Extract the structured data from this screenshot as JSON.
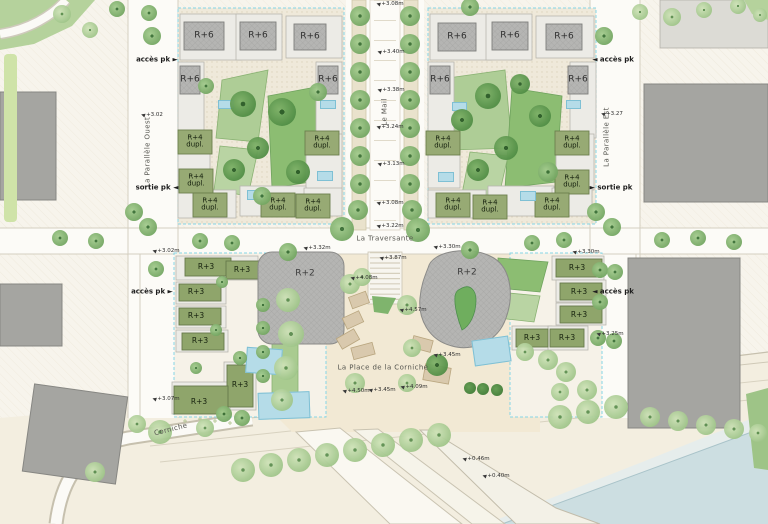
{
  "plan_type": "urban masterplan site plan",
  "streets": [
    {
      "id": "parallele-ouest",
      "label": "La Parallèle Ouest",
      "x": 148,
      "y": 152,
      "rotate": -90
    },
    {
      "id": "le-mail",
      "label": "Le Mail",
      "x": 385,
      "y": 112,
      "rotate": -90
    },
    {
      "id": "parallele-est",
      "label": "La Parallèle Est",
      "x": 607,
      "y": 137,
      "rotate": -90
    },
    {
      "id": "la-traversante",
      "label": "La Traversante",
      "x": 385,
      "y": 239,
      "rotate": 0
    },
    {
      "id": "place-corniche",
      "label": "La Place de la Corniche",
      "x": 383,
      "y": 368,
      "rotate": 0
    },
    {
      "id": "corniche",
      "label": "Corniche",
      "x": 171,
      "y": 430,
      "rotate": -14
    }
  ],
  "access_points": [
    {
      "label": "accès pk ►",
      "x": 157,
      "y": 60
    },
    {
      "label": "sortie pk ◄",
      "x": 157,
      "y": 188
    },
    {
      "label": "accès pk ►",
      "x": 152,
      "y": 292
    },
    {
      "label": "◄ accès pk",
      "x": 613,
      "y": 60
    },
    {
      "label": "► sortie pk",
      "x": 611,
      "y": 188
    },
    {
      "label": "◄ accès pk",
      "x": 613,
      "y": 292
    }
  ],
  "elevations": [
    {
      "v": "+3.08m",
      "x": 390,
      "y": 4
    },
    {
      "v": "+3.40m",
      "x": 391,
      "y": 52
    },
    {
      "v": "+3.38m",
      "x": 391,
      "y": 90
    },
    {
      "v": "+3.24m",
      "x": 390,
      "y": 127
    },
    {
      "v": "+3.13m",
      "x": 391,
      "y": 164
    },
    {
      "v": "+3.08m",
      "x": 390,
      "y": 203
    },
    {
      "v": "+3.22m",
      "x": 390,
      "y": 226
    },
    {
      "v": "+3.02",
      "x": 152,
      "y": 115
    },
    {
      "v": "+3.27",
      "x": 612,
      "y": 114
    },
    {
      "v": "+3.02m",
      "x": 166,
      "y": 251
    },
    {
      "v": "+3.07m",
      "x": 166,
      "y": 399
    },
    {
      "v": "+3.30m",
      "x": 586,
      "y": 252
    },
    {
      "v": "+3.25m",
      "x": 610,
      "y": 334
    },
    {
      "v": "+3.32m",
      "x": 317,
      "y": 248
    },
    {
      "v": "+3.30m",
      "x": 447,
      "y": 247
    },
    {
      "v": "+3.87m",
      "x": 393,
      "y": 258
    },
    {
      "v": "+4.08m",
      "x": 364,
      "y": 278
    },
    {
      "v": "+4.57m",
      "x": 413,
      "y": 310
    },
    {
      "v": "+3.45m",
      "x": 447,
      "y": 355
    },
    {
      "v": "+3.45m",
      "x": 382,
      "y": 390
    },
    {
      "v": "+4.50m",
      "x": 356,
      "y": 391
    },
    {
      "v": "+4.09m",
      "x": 414,
      "y": 387
    },
    {
      "v": "+0.46m",
      "x": 476,
      "y": 459
    },
    {
      "v": "+0.40m",
      "x": 496,
      "y": 476
    }
  ],
  "buildings": {
    "r6": {
      "label": "R+6",
      "positions": [
        [
          204,
          36
        ],
        [
          258,
          36
        ],
        [
          310,
          37
        ],
        [
          190,
          80
        ],
        [
          328,
          80
        ],
        [
          457,
          37
        ],
        [
          510,
          36
        ],
        [
          564,
          37
        ],
        [
          440,
          80
        ],
        [
          578,
          80
        ]
      ]
    },
    "r4": {
      "label": "R+4\ndupl.",
      "positions": [
        [
          195,
          142
        ],
        [
          322,
          143
        ],
        [
          196,
          181
        ],
        [
          210,
          205
        ],
        [
          278,
          205
        ],
        [
          313,
          206
        ],
        [
          443,
          143
        ],
        [
          572,
          143
        ],
        [
          572,
          182
        ],
        [
          453,
          205
        ],
        [
          490,
          207
        ],
        [
          552,
          205
        ]
      ]
    },
    "r3": {
      "label": "R+3",
      "positions": [
        [
          206,
          267
        ],
        [
          242,
          270
        ],
        [
          196,
          292
        ],
        [
          196,
          316
        ],
        [
          200,
          341
        ],
        [
          240,
          385
        ],
        [
          199,
          402
        ],
        [
          577,
          268
        ],
        [
          579,
          292
        ],
        [
          579,
          315
        ],
        [
          532,
          338
        ],
        [
          567,
          338
        ]
      ]
    },
    "r2": {
      "label": "R+2",
      "positions": [
        [
          305,
          274
        ],
        [
          467,
          273
        ]
      ]
    }
  },
  "colors": {
    "paper": "#f7f4ec",
    "road_white": "#fcfbf7",
    "curb": "#cfcabc",
    "courtyard": "#efe9da",
    "block_boundary_cyan": "#86d5e6",
    "building_gray": "#b5b5b3",
    "context_gray": "#a5a5a1",
    "olive_building": "#97aa74",
    "park_green": "#8cbd72",
    "park_light": "#aecd96",
    "tree_green": "#6fa35e",
    "pool_blue": "#b5dce8",
    "water": "#ccdee1",
    "plaza_sand": "#f2e9d4",
    "planter_tan": "#d9c9ad"
  },
  "scene": {
    "trees": [
      [
        360,
        16,
        10,
        "m"
      ],
      [
        410,
        16,
        10,
        "m"
      ],
      [
        360,
        44,
        10,
        "m"
      ],
      [
        410,
        44,
        10,
        "m"
      ],
      [
        360,
        72,
        10,
        "m"
      ],
      [
        410,
        72,
        10,
        "m"
      ],
      [
        360,
        100,
        10,
        "m"
      ],
      [
        410,
        100,
        10,
        "m"
      ],
      [
        360,
        128,
        10,
        "m"
      ],
      [
        410,
        128,
        10,
        "m"
      ],
      [
        360,
        156,
        10,
        "m"
      ],
      [
        410,
        156,
        10,
        "m"
      ],
      [
        360,
        184,
        10,
        "m"
      ],
      [
        410,
        184,
        10,
        "m"
      ],
      [
        358,
        210,
        10,
        "m"
      ],
      [
        412,
        210,
        10,
        "m"
      ],
      [
        342,
        229,
        12,
        "m"
      ],
      [
        418,
        230,
        12,
        "m"
      ],
      [
        152,
        36,
        9,
        "m"
      ],
      [
        134,
        212,
        9,
        "m"
      ],
      [
        148,
        227,
        9,
        "m"
      ],
      [
        604,
        36,
        9,
        "m"
      ],
      [
        596,
        212,
        9,
        "m"
      ],
      [
        612,
        227,
        9,
        "m"
      ],
      [
        117,
        9,
        8,
        "m"
      ],
      [
        149,
        13,
        8,
        "m"
      ],
      [
        470,
        7,
        9,
        "m"
      ],
      [
        640,
        12,
        8,
        "l"
      ],
      [
        672,
        17,
        9,
        "l"
      ],
      [
        704,
        10,
        8,
        "l"
      ],
      [
        738,
        6,
        8,
        "l"
      ],
      [
        760,
        15,
        7,
        "l"
      ],
      [
        62,
        14,
        9,
        "l"
      ],
      [
        90,
        30,
        8,
        "l"
      ],
      [
        60,
        238,
        8,
        "m"
      ],
      [
        96,
        241,
        8,
        "m"
      ],
      [
        200,
        241,
        8,
        "m"
      ],
      [
        232,
        243,
        8,
        "m"
      ],
      [
        288,
        252,
        9,
        "m"
      ],
      [
        470,
        250,
        9,
        "m"
      ],
      [
        532,
        243,
        8,
        "m"
      ],
      [
        564,
        240,
        8,
        "m"
      ],
      [
        662,
        240,
        8,
        "m"
      ],
      [
        698,
        238,
        8,
        "m"
      ],
      [
        734,
        242,
        8,
        "m"
      ],
      [
        243,
        104,
        13,
        "d"
      ],
      [
        282,
        112,
        14,
        "d"
      ],
      [
        258,
        148,
        11,
        "d"
      ],
      [
        234,
        170,
        11,
        "d"
      ],
      [
        298,
        172,
        12,
        "d"
      ],
      [
        318,
        92,
        9,
        "m"
      ],
      [
        206,
        86,
        8,
        "m"
      ],
      [
        262,
        196,
        9,
        "m"
      ],
      [
        488,
        96,
        13,
        "d"
      ],
      [
        462,
        120,
        11,
        "d"
      ],
      [
        520,
        84,
        10,
        "d"
      ],
      [
        540,
        116,
        11,
        "d"
      ],
      [
        506,
        148,
        12,
        "d"
      ],
      [
        478,
        170,
        11,
        "d"
      ],
      [
        548,
        172,
        10,
        "m"
      ],
      [
        263,
        305,
        7,
        "m"
      ],
      [
        263,
        328,
        7,
        "m"
      ],
      [
        263,
        352,
        7,
        "m"
      ],
      [
        263,
        376,
        7,
        "m"
      ],
      [
        288,
        300,
        12,
        "l"
      ],
      [
        291,
        334,
        13,
        "l"
      ],
      [
        286,
        368,
        12,
        "l"
      ],
      [
        282,
        400,
        11,
        "l"
      ],
      [
        222,
        282,
        6,
        "m"
      ],
      [
        216,
        330,
        6,
        "m"
      ],
      [
        240,
        358,
        7,
        "m"
      ],
      [
        196,
        368,
        6,
        "m"
      ],
      [
        224,
        414,
        8,
        "m"
      ],
      [
        242,
        418,
        8,
        "m"
      ],
      [
        156,
        269,
        8,
        "m"
      ],
      [
        548,
        360,
        10,
        "l"
      ],
      [
        566,
        372,
        10,
        "l"
      ],
      [
        525,
        352,
        9,
        "l"
      ],
      [
        600,
        270,
        8,
        "m"
      ],
      [
        615,
        272,
        8,
        "m"
      ],
      [
        600,
        302,
        8,
        "m"
      ],
      [
        598,
        338,
        8,
        "m"
      ],
      [
        614,
        341,
        8,
        "m"
      ],
      [
        587,
        390,
        10,
        "l"
      ],
      [
        560,
        392,
        9,
        "l"
      ],
      [
        350,
        284,
        10,
        "l"
      ],
      [
        362,
        277,
        9,
        "l"
      ],
      [
        407,
        305,
        10,
        "l"
      ],
      [
        412,
        348,
        9,
        "l"
      ],
      [
        437,
        365,
        11,
        "d"
      ],
      [
        355,
        383,
        10,
        "l"
      ],
      [
        407,
        383,
        9,
        "l"
      ],
      [
        470,
        388,
        6,
        "s"
      ],
      [
        483,
        389,
        6,
        "s"
      ],
      [
        497,
        390,
        6,
        "s"
      ],
      [
        243,
        470,
        12,
        "l"
      ],
      [
        271,
        465,
        12,
        "l"
      ],
      [
        299,
        460,
        12,
        "l"
      ],
      [
        327,
        455,
        12,
        "l"
      ],
      [
        355,
        450,
        12,
        "l"
      ],
      [
        383,
        445,
        12,
        "l"
      ],
      [
        411,
        440,
        12,
        "l"
      ],
      [
        439,
        435,
        12,
        "l"
      ],
      [
        560,
        417,
        12,
        "l"
      ],
      [
        588,
        412,
        12,
        "l"
      ],
      [
        616,
        407,
        12,
        "l"
      ],
      [
        650,
        417,
        10,
        "l"
      ],
      [
        678,
        421,
        10,
        "l"
      ],
      [
        706,
        425,
        10,
        "l"
      ],
      [
        734,
        429,
        10,
        "l"
      ],
      [
        758,
        433,
        9,
        "l"
      ],
      [
        95,
        472,
        10,
        "l"
      ],
      [
        160,
        432,
        12,
        "l"
      ],
      [
        205,
        428,
        9,
        "l"
      ],
      [
        137,
        424,
        9,
        "l"
      ]
    ],
    "pools": [
      [
        218,
        100,
        16,
        9,
        0
      ],
      [
        320,
        100,
        16,
        9,
        0
      ],
      [
        247,
        190,
        16,
        10,
        0
      ],
      [
        317,
        171,
        16,
        10,
        0
      ],
      [
        452,
        102,
        15,
        9,
        0
      ],
      [
        566,
        100,
        15,
        9,
        0
      ],
      [
        438,
        172,
        16,
        10,
        0
      ],
      [
        520,
        191,
        16,
        10,
        0
      ],
      [
        246,
        348,
        36,
        26,
        4
      ],
      [
        473,
        338,
        37,
        26,
        -8
      ],
      [
        258,
        392,
        52,
        27,
        -2
      ]
    ]
  }
}
